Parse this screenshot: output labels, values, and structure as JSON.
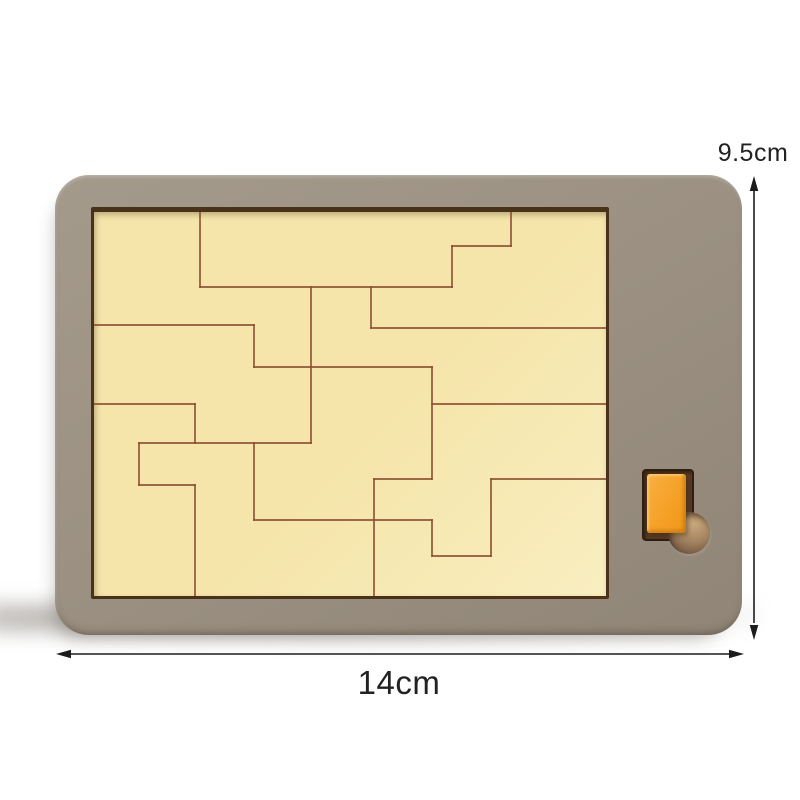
{
  "dimensions": {
    "height_label": "9.5cm",
    "width_label": "14cm"
  },
  "colors": {
    "background": "#ffffff",
    "board": "#9c9183",
    "board_light": "#a49a8c",
    "board_dark": "#908577",
    "recess_border": "#4a3119",
    "surface": "#f5e5aa",
    "surface_light": "#f9eec0",
    "piece_line": "#8a4a2e",
    "orange": "#f5a127",
    "orange_dark": "#ee9618",
    "slot": "#5a3c24",
    "hole_light": "#c9a77e",
    "hole_dark": "#6f5540",
    "arrow": "#1c1c1c",
    "label_text": "#222222"
  },
  "puzzle": {
    "width": 512,
    "height": 384,
    "segments": [
      [
        106,
        0,
        106,
        75
      ],
      [
        106,
        75,
        358,
        75
      ],
      [
        358,
        34,
        358,
        75
      ],
      [
        358,
        34,
        417,
        34
      ],
      [
        417,
        0,
        417,
        34
      ],
      [
        277,
        75,
        277,
        116
      ],
      [
        277,
        116,
        512,
        116
      ],
      [
        0,
        113,
        160,
        113
      ],
      [
        160,
        113,
        160,
        155
      ],
      [
        160,
        155,
        338,
        155
      ],
      [
        217,
        75,
        217,
        231
      ],
      [
        338,
        155,
        338,
        267
      ],
      [
        0,
        192,
        101,
        192
      ],
      [
        101,
        192,
        101,
        231
      ],
      [
        45,
        231,
        217,
        231
      ],
      [
        45,
        231,
        45,
        273
      ],
      [
        45,
        273,
        101,
        273
      ],
      [
        101,
        273,
        101,
        384
      ],
      [
        160,
        231,
        160,
        308
      ],
      [
        160,
        308,
        338,
        308
      ],
      [
        338,
        308,
        338,
        344
      ],
      [
        338,
        344,
        397,
        344
      ],
      [
        397,
        267,
        397,
        344
      ],
      [
        280,
        267,
        338,
        267
      ],
      [
        280,
        267,
        280,
        384
      ],
      [
        397,
        267,
        512,
        267
      ],
      [
        338,
        192,
        512,
        192
      ]
    ]
  }
}
